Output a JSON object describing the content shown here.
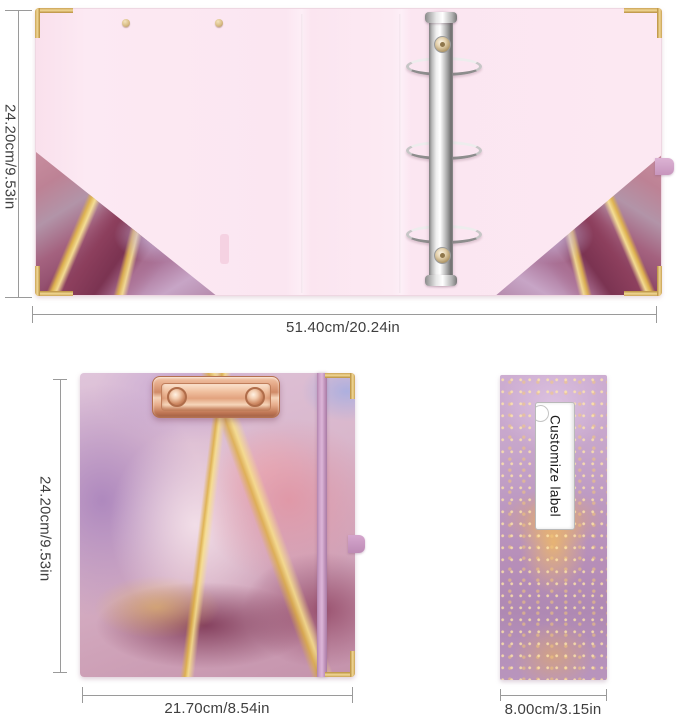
{
  "figure_open_binder": {
    "description": "open 3-ring binder padfolio interior view",
    "height_label": "24.20cm/9.53in",
    "width_label": "51.40cm/20.24in"
  },
  "figure_clipboard_front": {
    "description": "closed clipboard front cover with low-profile clip",
    "height_label": "24.20cm/9.53in",
    "width_label": "21.70cm/8.54in"
  },
  "figure_spine": {
    "sticker_text": "Customize label",
    "width_label": "8.00cm/3.15in"
  },
  "colors": {
    "dimension_line": "#9a9a9a",
    "dimension_text": "#3f3f3f",
    "interior_pink": "#fce8f2",
    "gold_corner": "#d9b25f",
    "marble_gold": "#e0b54d",
    "marble_purple": "#b08cc0",
    "marble_rose": "#dc9fae",
    "marble_magenta": "#8a4360",
    "rose_gold_clip": "#e3a583",
    "elastic_band": "#c9a3cf",
    "chrome_silver": "#d6d6d6",
    "label_background": "#ffffff"
  }
}
